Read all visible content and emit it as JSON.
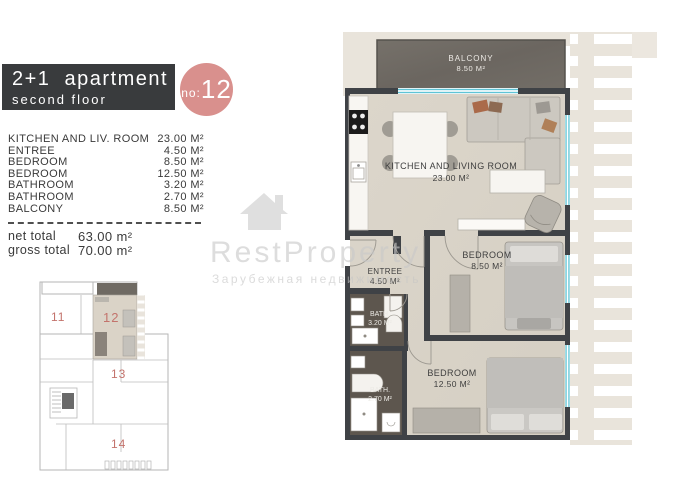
{
  "header": {
    "title": "2+1  apartment",
    "subtitle": "second floor",
    "unit_label": "no:",
    "unit_number": "12"
  },
  "area_table": {
    "rows": [
      {
        "label": "KITCHEN AND LIV. ROOM",
        "value": "23.00 M²"
      },
      {
        "label": "ENTREE",
        "value": "4.50 M²"
      },
      {
        "label": "BEDROOM",
        "value": "8.50 M²"
      },
      {
        "label": "BEDROOM",
        "value": "12.50 M²"
      },
      {
        "label": "BATHROOM",
        "value": "3.20 M²"
      },
      {
        "label": "BATHROOM",
        "value": "2.70 M²"
      },
      {
        "label": "BALCONY",
        "value": "8.50 M²"
      }
    ],
    "totals": [
      {
        "label": "net total",
        "value": "63.00 m²"
      },
      {
        "label": "gross total",
        "value": "70.00 m²"
      }
    ]
  },
  "watermark": {
    "brand": "RestProperty",
    "tagline": "Зарубежная недвижимость"
  },
  "floor_plan": {
    "rooms": {
      "balcony": {
        "name": "BALCONY",
        "area": "8.50 M²"
      },
      "kitchen_living": {
        "name": "KITCHEN AND LIVING ROOM",
        "area": "23.00 M²"
      },
      "entree": {
        "name": "ENTREE",
        "area": "4.50 M²"
      },
      "bedroom_1": {
        "name": "BEDROOM",
        "area": "8.50 M²"
      },
      "bedroom_2": {
        "name": "BEDROOM",
        "area": "12.50 M²"
      },
      "bath_1": {
        "name": "BATH.",
        "area": "3.20 M²"
      },
      "bath_2": {
        "name": "BATH.",
        "area": "2.70 M²"
      }
    },
    "colors": {
      "wall": "#3f4246",
      "floor": "#d9d3c7",
      "balcony_floor": "#6f6a63",
      "bath_floor": "#5d564e",
      "window": "#5fc4d6",
      "deck": "#e9e4db",
      "accent_pink": "#d9908d",
      "header_bg": "#393b3d"
    }
  },
  "mini_plan": {
    "units": [
      {
        "number": "11",
        "highlighted": false
      },
      {
        "number": "12",
        "highlighted": true
      },
      {
        "number": "13",
        "highlighted": false
      },
      {
        "number": "14",
        "highlighted": false
      }
    ]
  }
}
